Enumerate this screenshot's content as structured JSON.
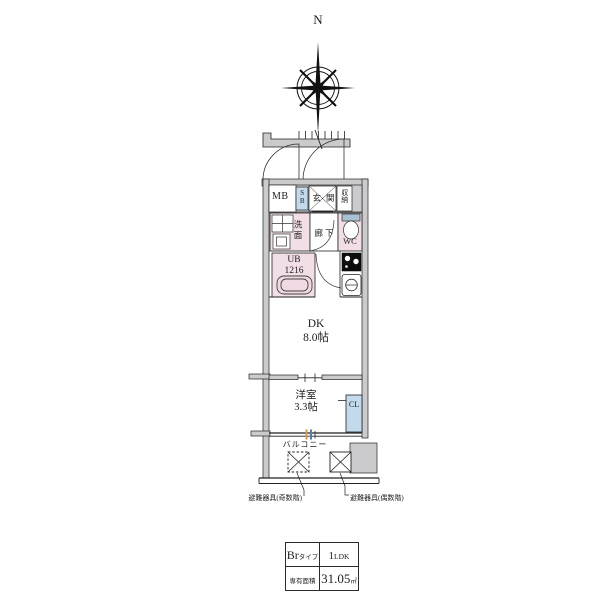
{
  "compass": {
    "north": "N"
  },
  "plan": {
    "labels": {
      "mb": "MB",
      "sb": "SB",
      "genkan": "玄関",
      "storage": "収納",
      "washroom": "洗面",
      "hallway": "廊下",
      "wc": "WC",
      "unit_bath": "UB\n1216",
      "dk": "DK\n8.0帖",
      "western_room": "洋室\n3.3帖",
      "closet": "CL",
      "balcony": "バルコニー"
    },
    "annotations": {
      "evac_odd": "避難器具(奇数階)",
      "evac_even": "避難器具(偶数階)"
    },
    "colors": {
      "wall_gray": "#cbcbcd",
      "room_pink": "#f2dee6",
      "unit_blue": "#c3d9ec",
      "line": "#222222",
      "window_orange": "#d29a53",
      "window_blue": "#5878a8"
    }
  },
  "spec_table": {
    "type_name": "Br",
    "type_suffix": "タイプ",
    "plan_number": "1",
    "plan_suffix": "LDK",
    "area_label": "専有面積",
    "area_value": "31.05",
    "area_unit": "㎡"
  }
}
